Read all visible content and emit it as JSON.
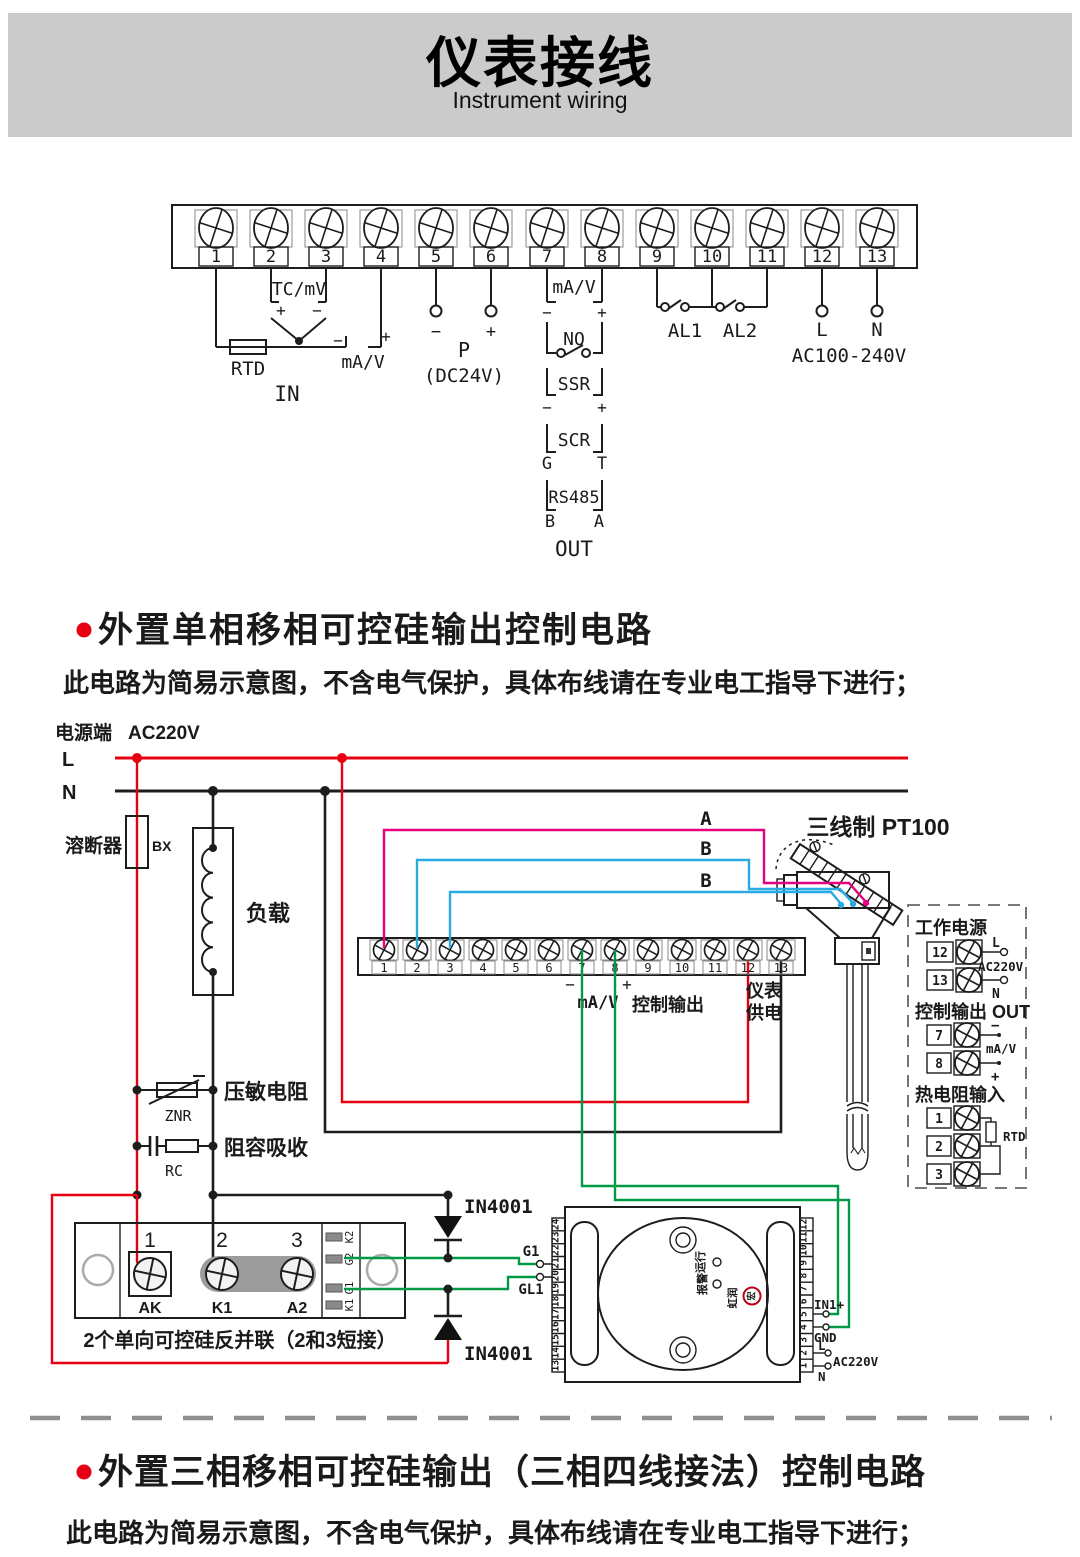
{
  "header": {
    "title": "仪表接线",
    "subtitle": "Instrument wiring"
  },
  "top": {
    "terminals": [
      "1",
      "2",
      "3",
      "4",
      "5",
      "6",
      "7",
      "8",
      "9",
      "10",
      "11",
      "12",
      "13"
    ],
    "labels": {
      "tc": "TC/mV",
      "tc_plus": "+",
      "tc_minus": "−",
      "rtd": "RTD",
      "in_minus": "−",
      "in_ma_v": "mA/V",
      "in_plus": "+",
      "in": "IN",
      "p_minus": "−",
      "p_plus": "+",
      "p": "P",
      "dc24v": "(DC24V)",
      "out_ma_v": "mA/V",
      "om": "−",
      "op": "+",
      "no": "NO",
      "ssr": "SSR",
      "sm": "−",
      "sp": "+",
      "scr": "SCR",
      "g": "G",
      "t": "T",
      "rs485": "RS485",
      "b": "B",
      "a": "A",
      "out": "OUT",
      "al1": "AL1",
      "al2": "AL2",
      "l": "L",
      "n": "N",
      "ac": "AC100-240V"
    }
  },
  "section1": {
    "title": "外置单相移相可控硅输出控制电路",
    "note": "此电路为简易示意图，不含电气保护，具体布线请在专业电工指导下进行；"
  },
  "c": {
    "power": "电源端",
    "voltage": "AC220V",
    "l": "L",
    "n": "N",
    "fuse": "溶断器",
    "bx": "BX",
    "load": "负载",
    "znr_label": "压敏电阻",
    "znr": "ZNR",
    "rc_label": "阻容吸收",
    "rc": "RC",
    "strip": {
      "terminals": [
        "1",
        "2",
        "3",
        "4",
        "5",
        "6",
        "7",
        "8",
        "9",
        "10",
        "11",
        "12",
        "13"
      ],
      "minus": "−",
      "plus": "+",
      "ma_v": "mA/V",
      "ctrl": "控制输出",
      "sup1": "仪表",
      "sup2": "供电"
    },
    "sensor": {
      "title": "三线制 PT100",
      "a": "A",
      "b1": "B",
      "b2": "B"
    },
    "panel": {
      "power_title": "工作电源",
      "t12": "12",
      "t13": "13",
      "l": "L",
      "n": "N",
      "ac": "AC220V",
      "out_title": "控制输出 OUT",
      "t7": "7",
      "t8": "8",
      "minus": "−",
      "plus": "+",
      "ma_v": "mA/V",
      "rtd_title": "热电阻输入",
      "t1": "1",
      "t2": "2",
      "t3": "3",
      "rtd": "RTD"
    },
    "scr": {
      "n1": "1",
      "n2": "2",
      "n3": "3",
      "ak": "AK",
      "k1": "K1",
      "a2": "A2",
      "pins": [
        "K2",
        "G2",
        "G1",
        "K1"
      ],
      "caption": "2个单向可控硅反并联（2和3短接）"
    },
    "d1": "IN4001",
    "d2": "IN4001",
    "g1": "G1",
    "gl1": "GL1",
    "module": {
      "left": [
        "24",
        "23",
        "22",
        "21",
        "20",
        "19",
        "18",
        "17",
        "16",
        "15",
        "14",
        "13"
      ],
      "right": [
        "12",
        "11",
        "10",
        "9",
        "8",
        "7",
        "6",
        "5",
        "4",
        "3",
        "2",
        "1"
      ],
      "run": "运行",
      "alarm": "报警",
      "brand": "虹润",
      "glyph": "宏",
      "in1": "IN1+",
      "gnd": "GND",
      "l": "L",
      "ac": "AC220V",
      "n": "N"
    }
  },
  "section2": {
    "title": "外置三相移相可控硅输出（三相四线接法）控制电路",
    "note": "此电路为简易示意图，不含电气保护，具体布线请在专业电工指导下进行；"
  }
}
